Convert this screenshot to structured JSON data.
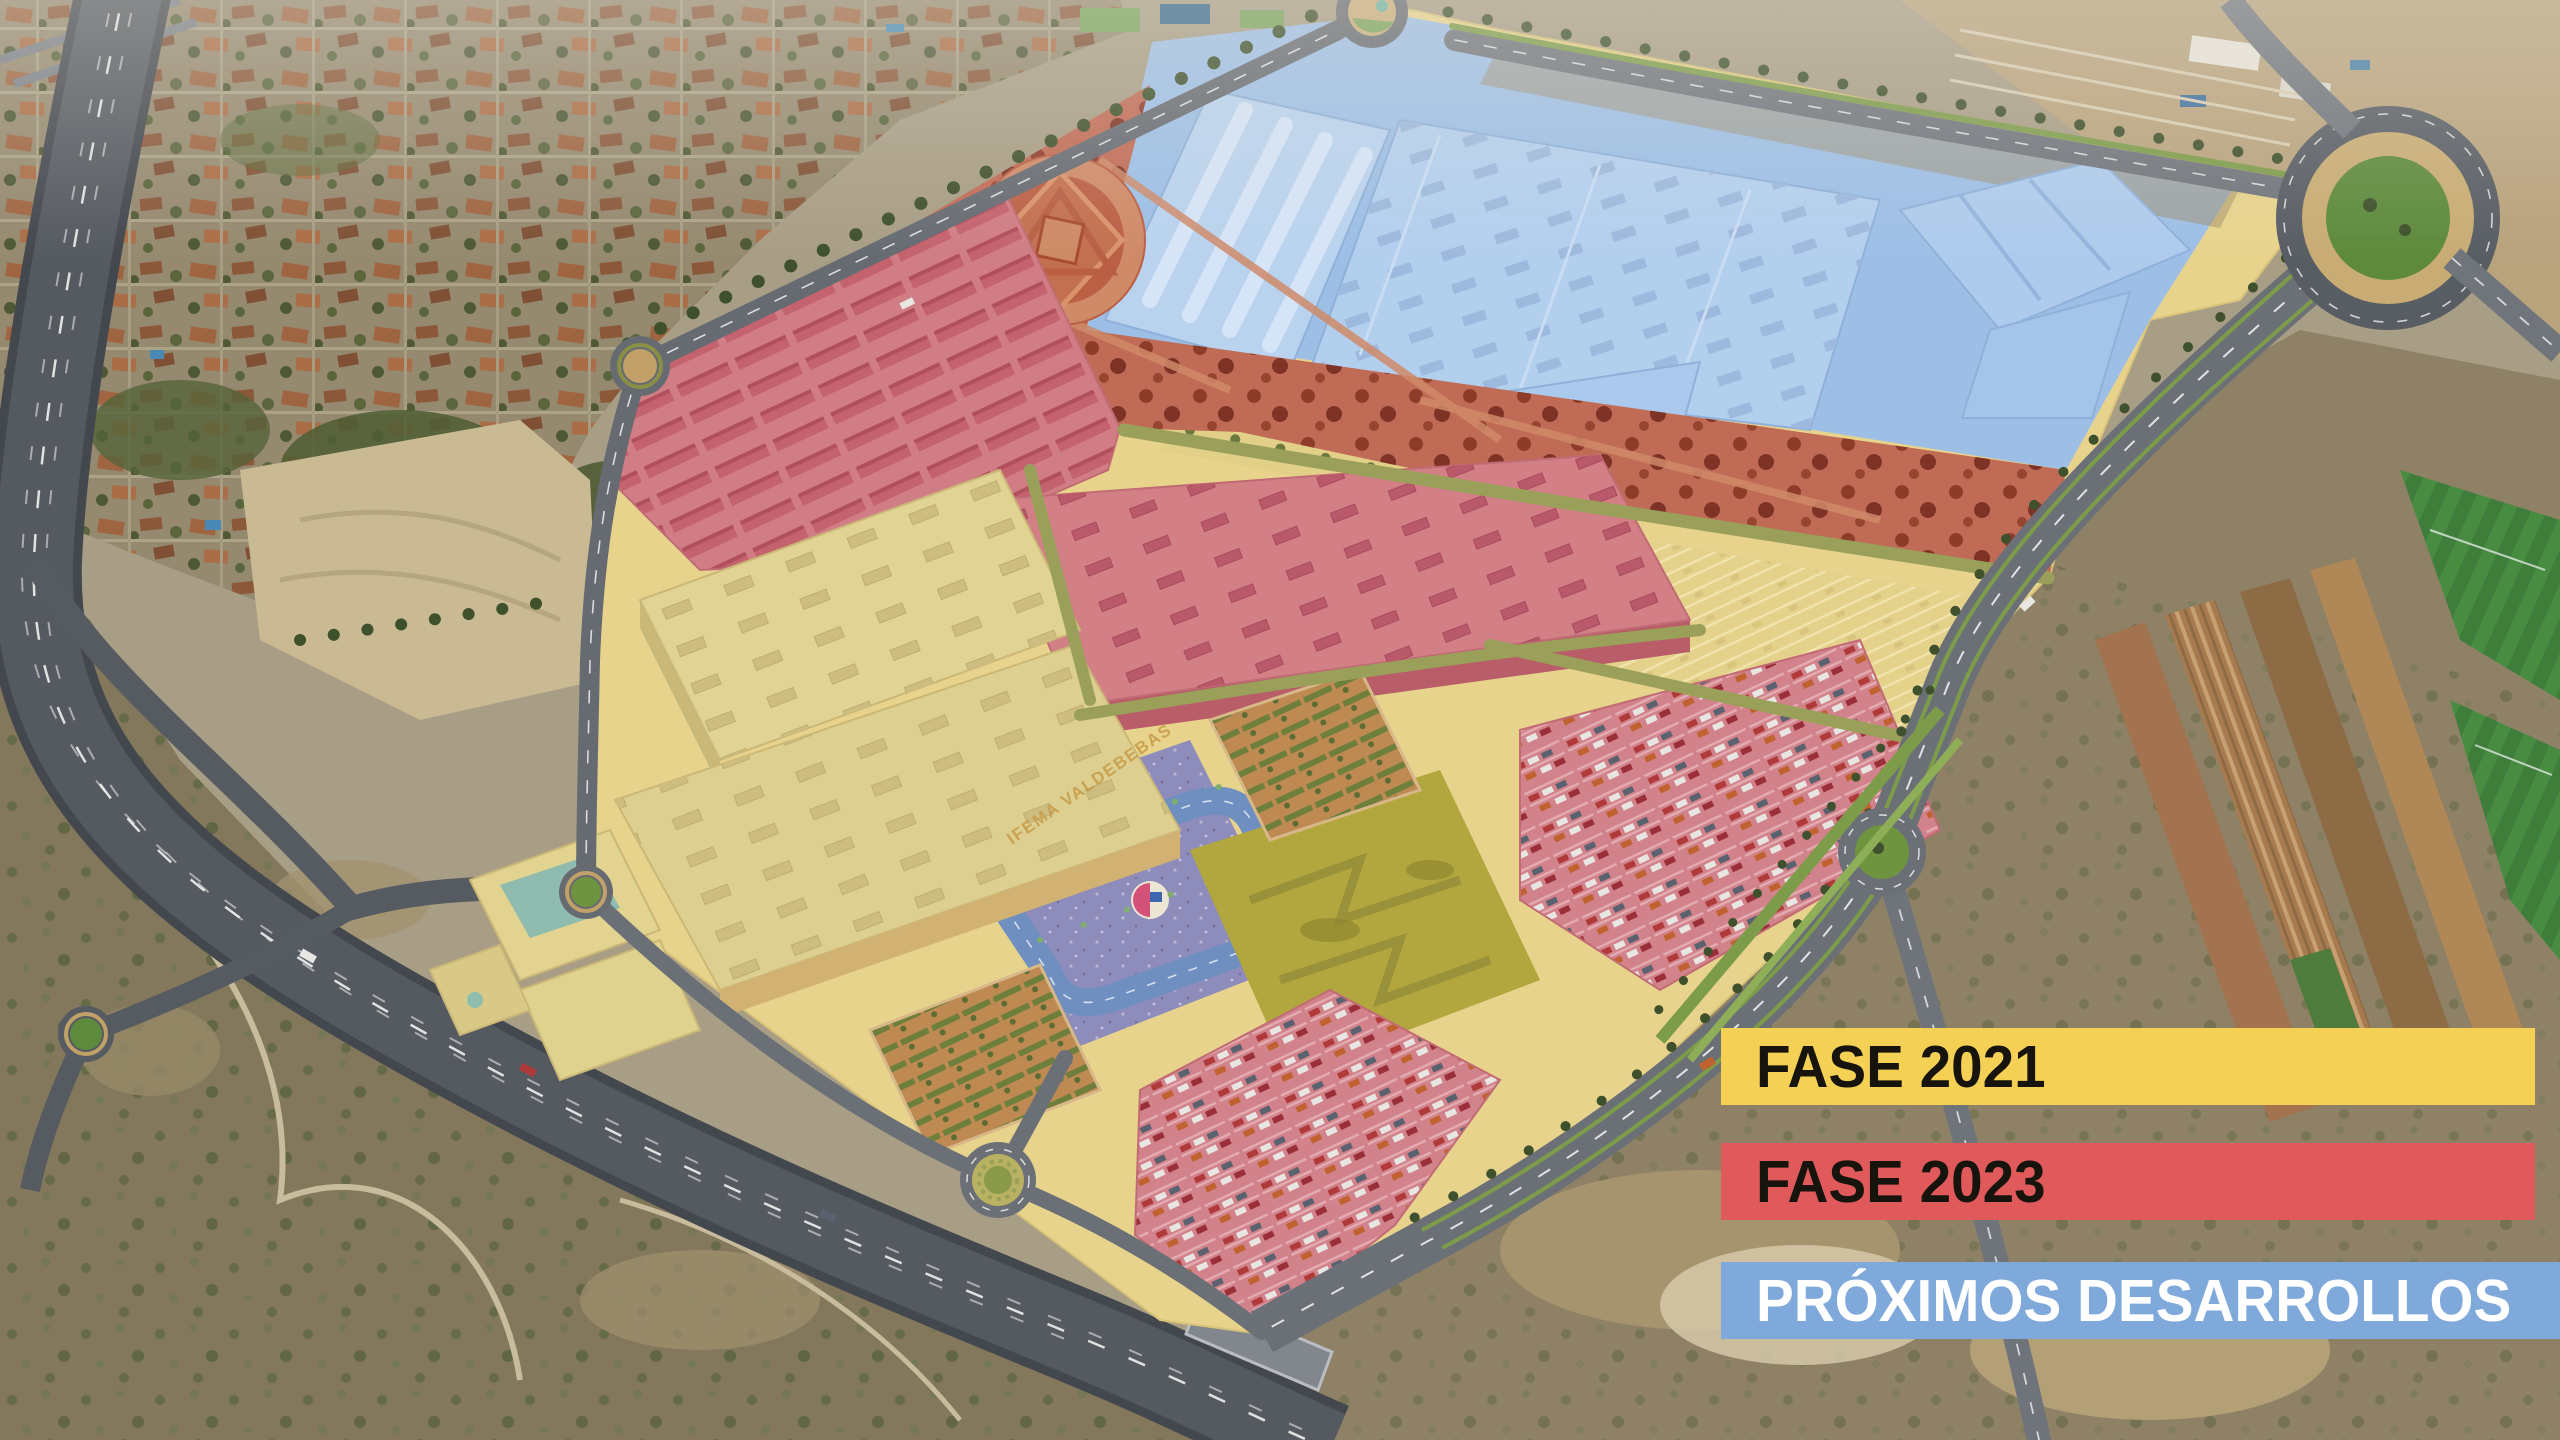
{
  "legend": {
    "items": [
      {
        "id": "fase-2021",
        "label": "FASE 2021",
        "color": "#F4D155",
        "text_color": "#17130D"
      },
      {
        "id": "fase-2023",
        "label": "FASE 2023",
        "color": "#E15A5B",
        "text_color": "#17130D"
      },
      {
        "id": "proximos-desarrollos",
        "label": "PRÓXIMOS DESARROLLOS",
        "color": "#7FA9DB",
        "text_color": "#FFFFFF"
      }
    ]
  },
  "map": {
    "building_label": "IFEMA VALDEBEBAS",
    "zones": [
      {
        "id": "fase-2021",
        "name": "FASE 2021",
        "overlay_color": "#E7D38C"
      },
      {
        "id": "fase-2023",
        "name": "FASE 2023",
        "overlay_color": "#D27F86"
      },
      {
        "id": "proximos-desarrollos",
        "name": "PRÓXIMOS DESARROLLOS",
        "overlay_color": "#9DBFE6"
      }
    ]
  }
}
